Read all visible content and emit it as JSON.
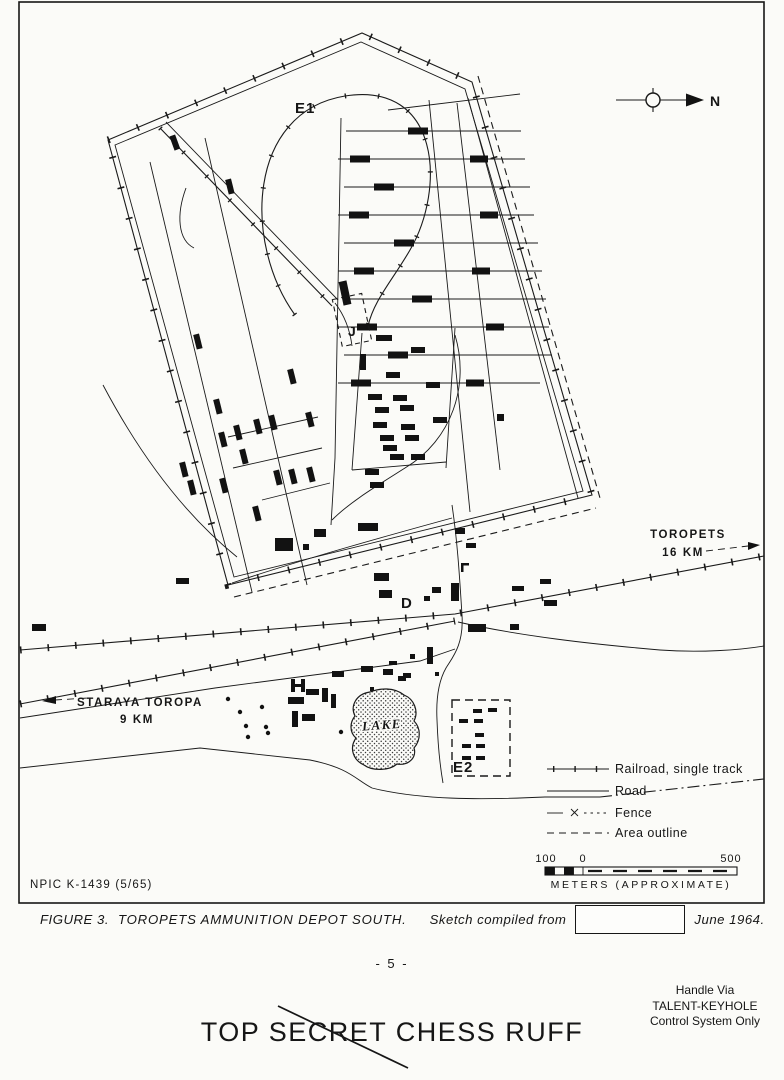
{
  "map": {
    "area_labels": {
      "e1": "E1",
      "j": "J",
      "d": "D",
      "e2": "E2",
      "lake": "LAKE"
    },
    "north_label": "N",
    "directions": {
      "toropets": {
        "name": "TOROPETS",
        "distance": "16 KM"
      },
      "staraya_toropa": {
        "name": "STARAYA TOROPA",
        "distance": "9 KM"
      }
    },
    "legend": {
      "items": [
        {
          "symbol": "railroad-single-track",
          "label": "Railroad, single track"
        },
        {
          "symbol": "road",
          "label": "Road"
        },
        {
          "symbol": "fence",
          "label": "Fence"
        },
        {
          "symbol": "area-outline",
          "label": "Area outline"
        }
      ]
    },
    "scale": {
      "left": "100",
      "zero": "0",
      "right": "500",
      "units": "METERS (APPROXIMATE)"
    },
    "credit": "NPIC K-1439 (5/65)"
  },
  "caption": {
    "figure": "FIGURE 3.",
    "title": "TOROPETS AMMUNITION DEPOT SOUTH.",
    "note": "Sketch compiled from",
    "date": "June 1964."
  },
  "footer": {
    "page_number": "- 5 -",
    "handling": [
      "Handle Via",
      "TALENT-KEYHOLE",
      "Control System Only"
    ],
    "classification": "TOP SECRET CHESS RUFF"
  },
  "colors": {
    "ink": "#161616",
    "paper": "#fbfbf8"
  }
}
